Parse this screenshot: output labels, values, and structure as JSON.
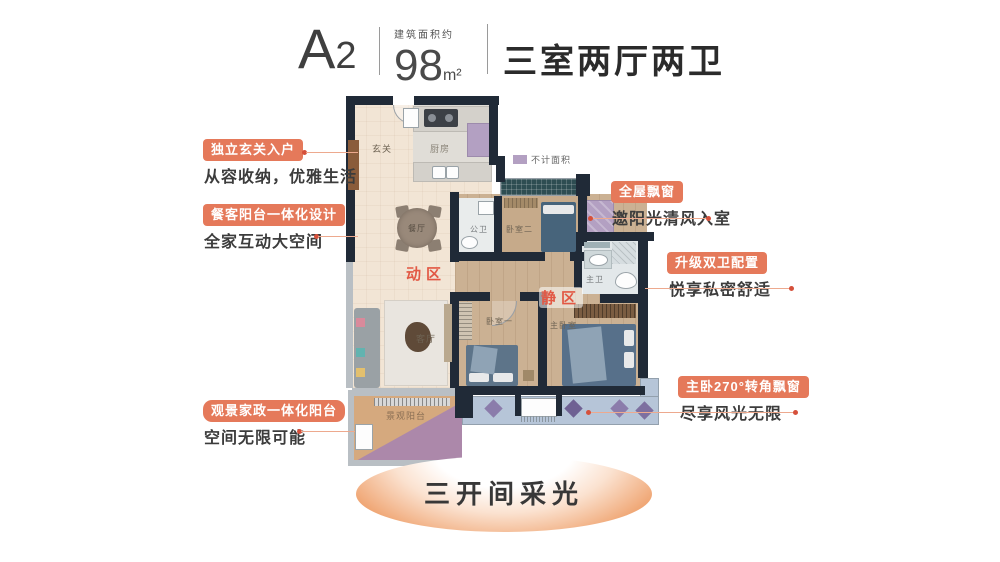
{
  "header": {
    "unit_name_letter": "A",
    "unit_name_number": "2",
    "area_label": "建筑面积约",
    "area_value": "98",
    "area_unit": "m²",
    "layout_title": "三室两厅两卫"
  },
  "legend": {
    "not_counted": "不计面积",
    "swatch_color": "#b3a0c2"
  },
  "callouts": {
    "left": [
      {
        "title": "独立玄关入户",
        "desc": "从容收纳，优雅生活"
      },
      {
        "title": "餐客阳台一体化设计",
        "desc": "全家互动大空间"
      },
      {
        "title": "观景家政一体化阳台",
        "desc": "空间无限可能"
      }
    ],
    "right": [
      {
        "title": "全屋飘窗",
        "desc": "邀阳光清风入室"
      },
      {
        "title": "升级双卫配置",
        "desc": "悦享私密舒适"
      },
      {
        "title": "主卧270°转角飘窗",
        "desc": "尽享风光无限"
      }
    ]
  },
  "floorplan": {
    "rooms": {
      "entry": "玄关",
      "kitchen": "厨房",
      "dining": "餐厅",
      "living": "客厅",
      "public_bath": "公卫",
      "bedroom2": "卧室二",
      "master_bath": "主卫",
      "bedroom1": "卧室一",
      "master_bedroom": "主卧室",
      "view_balcony": "景观阳台"
    },
    "zones": {
      "active": "动区",
      "quiet": "静区"
    }
  },
  "footer": {
    "banner": "三开间采光"
  },
  "colors": {
    "accent": "#e5795a",
    "zone_text": "#e25844",
    "wall": "#202a37",
    "not_counted_purple": "#b3a0c2",
    "bay_window_blue": "#b6c5d8"
  }
}
